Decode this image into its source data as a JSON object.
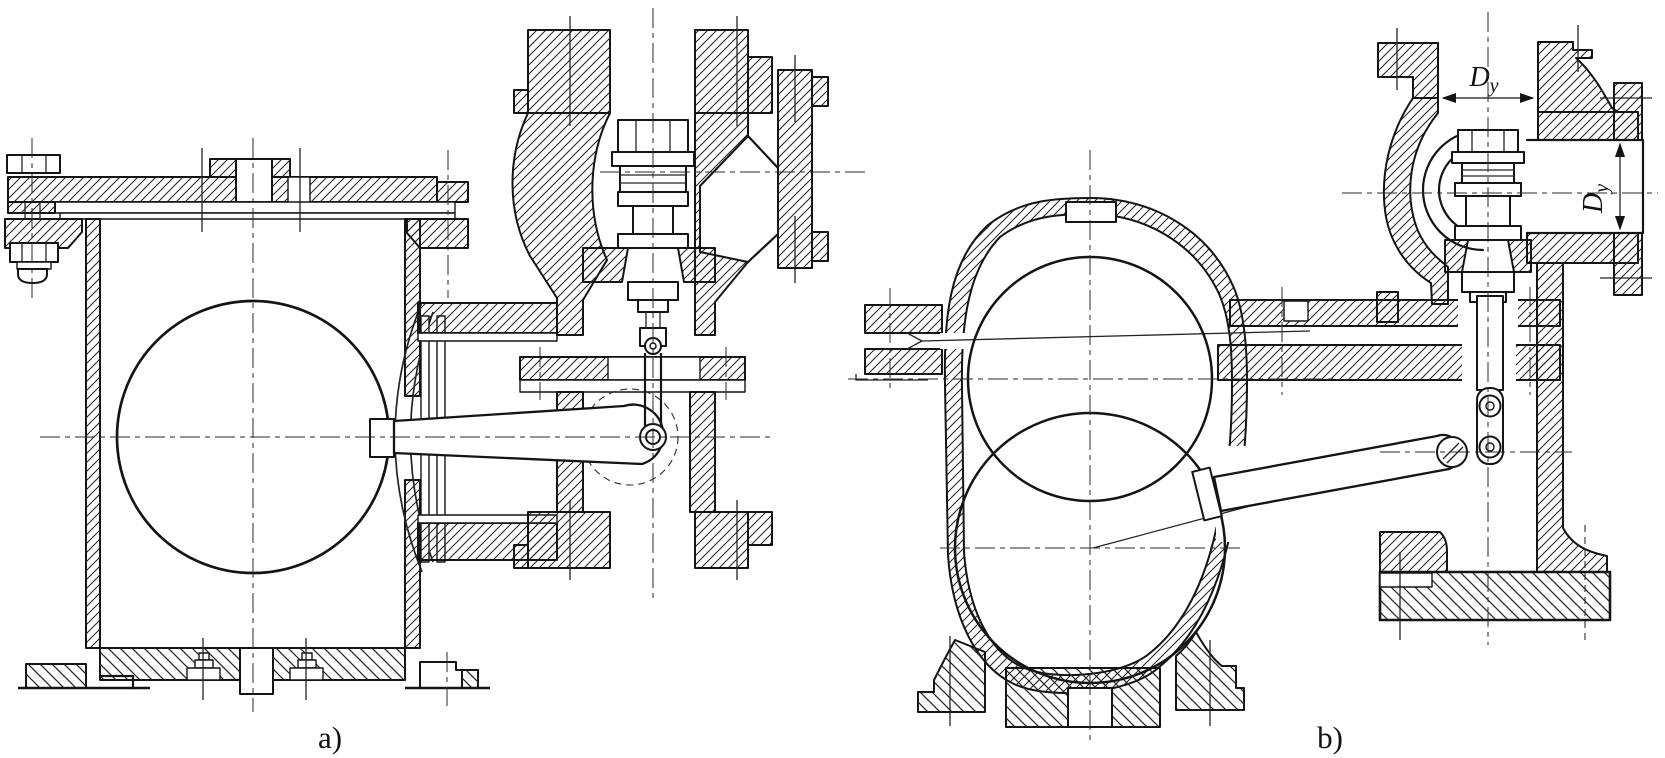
{
  "drawing": {
    "background": "#ffffff",
    "line_color": "#141414",
    "views": {
      "a": {
        "caption": "a)"
      },
      "b": {
        "caption": "b)"
      }
    },
    "dimensions": {
      "nominal_diameter_top": {
        "symbol": "D",
        "subscript": "y"
      },
      "nominal_diameter_side": {
        "symbol": "D",
        "subscript": "y"
      }
    }
  }
}
